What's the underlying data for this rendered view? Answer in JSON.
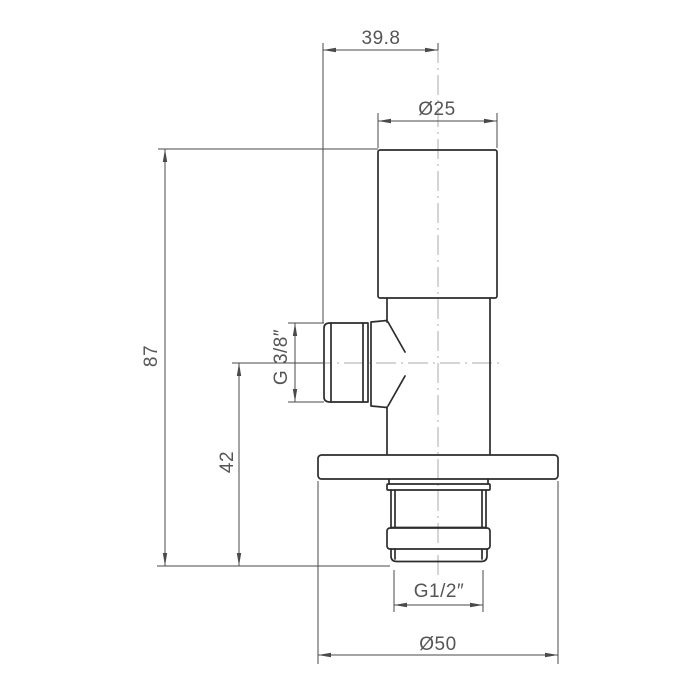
{
  "drawing": {
    "background_color": "#ffffff",
    "outline_color": "#2d2d2d",
    "dimension_color": "#4a4a4a",
    "centerline_color": "#ababab",
    "dimensions": {
      "port_offset": "39.8",
      "cap_diameter": "Ø25",
      "total_height": "87",
      "side_thread": "G 3/8″",
      "port_axis_height": "42",
      "bottom_thread": "G1/2″",
      "flange_diameter": "Ø50"
    }
  }
}
